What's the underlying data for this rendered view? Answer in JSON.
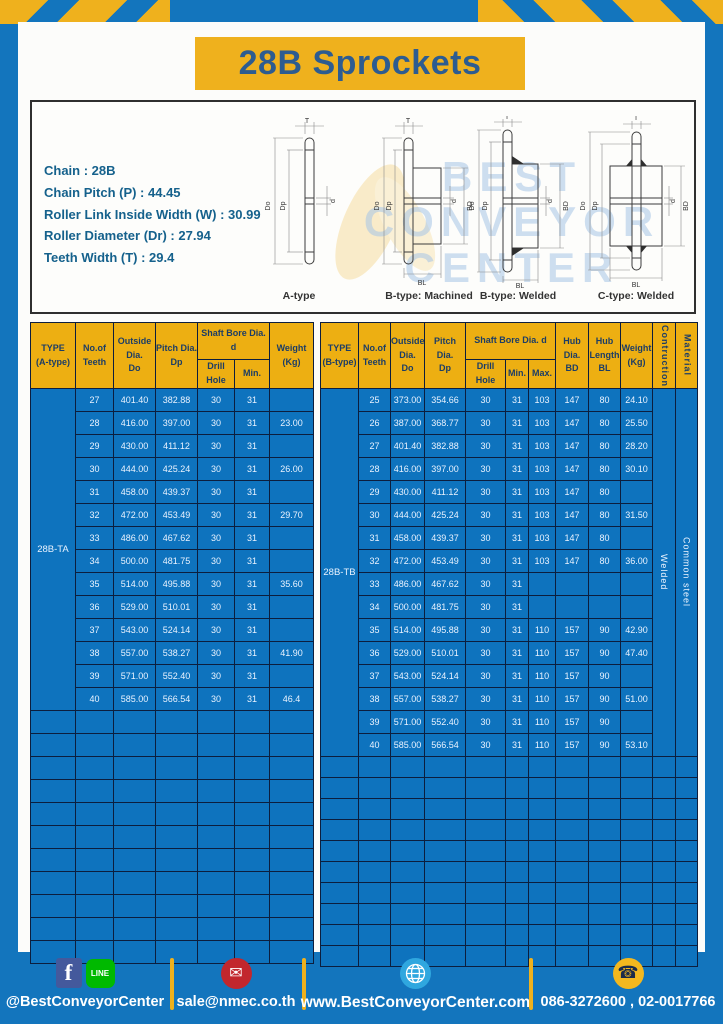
{
  "page": {
    "title": "28B Sprockets"
  },
  "colors": {
    "page_blue": "#1375BD",
    "accent_yellow": "#EFB11D",
    "cell_blue": "#0E73BE",
    "header_navy": "#1C3D66",
    "border_navy": "#0C1E3E",
    "title_navy": "#2D5C90"
  },
  "specs": {
    "lines": [
      "Chain : 28B",
      "Chain Pitch (P) : 44.45",
      "Roller Link Inside Width (W) : 30.99",
      "Roller Diameter (Dr) : 27.94",
      "Teeth Width (T) : 29.4"
    ]
  },
  "watermark": {
    "lines": [
      "BEST",
      "CONVEYOR",
      "CENTER"
    ]
  },
  "diagrams": {
    "captions": [
      "A-type",
      "B-type: Machined",
      "B-type: Welded",
      "C-type: Welded"
    ],
    "dims": {
      "t": "T",
      "do": "Do",
      "dp": "Dp",
      "d": "d",
      "bd": "BD",
      "bl": "BL"
    }
  },
  "table_a": {
    "headers": {
      "type": "TYPE\n(A-type)",
      "teeth": "No.of\nTeeth",
      "outside": "Outside\nDia.\nDo",
      "pitch": "Pitch Dia.\nDp",
      "shaft": "Shaft Bore Dia. d",
      "drill": "Drill Hole",
      "min": "Min.",
      "weight": "Weight\n(Kg)"
    },
    "type_label": "28B-TA",
    "rows": [
      [
        "27",
        "401.40",
        "382.88",
        "30",
        "31",
        ""
      ],
      [
        "28",
        "416.00",
        "397.00",
        "30",
        "31",
        "23.00"
      ],
      [
        "29",
        "430.00",
        "411.12",
        "30",
        "31",
        ""
      ],
      [
        "30",
        "444.00",
        "425.24",
        "30",
        "31",
        "26.00"
      ],
      [
        "31",
        "458.00",
        "439.37",
        "30",
        "31",
        ""
      ],
      [
        "32",
        "472.00",
        "453.49",
        "30",
        "31",
        "29.70"
      ],
      [
        "33",
        "486.00",
        "467.62",
        "30",
        "31",
        ""
      ],
      [
        "34",
        "500.00",
        "481.75",
        "30",
        "31",
        ""
      ],
      [
        "35",
        "514.00",
        "495.88",
        "30",
        "31",
        "35.60"
      ],
      [
        "36",
        "529.00",
        "510.01",
        "30",
        "31",
        ""
      ],
      [
        "37",
        "543.00",
        "524.14",
        "30",
        "31",
        ""
      ],
      [
        "38",
        "557.00",
        "538.27",
        "30",
        "31",
        "41.90"
      ],
      [
        "39",
        "571.00",
        "552.40",
        "30",
        "31",
        ""
      ],
      [
        "40",
        "585.00",
        "566.54",
        "30",
        "31",
        "46.4"
      ]
    ],
    "empty_rows": 11,
    "total_cols": 7
  },
  "table_b": {
    "headers": {
      "type": "TYPE\n(B-type)",
      "teeth": "No.of\nTeeth",
      "outside": "Outside\nDia.\nDo",
      "pitch": "Pitch Dia.\nDp",
      "shaft": "Shaft Bore Dia. d",
      "drill": "Drill Hole",
      "min": "Min.",
      "max": "Max.",
      "hub_dia": "Hub Dia.\nBD",
      "hub_len": "Hub\nLength\nBL",
      "weight": "Weight\n(Kg)",
      "construction": "Contruction",
      "material": "Material"
    },
    "type_label": "28B-TB",
    "construction_value": "Welded",
    "material_value": "Common steel",
    "rows": [
      [
        "25",
        "373.00",
        "354.66",
        "30",
        "31",
        "103",
        "147",
        "80",
        "24.10"
      ],
      [
        "26",
        "387.00",
        "368.77",
        "30",
        "31",
        "103",
        "147",
        "80",
        "25.50"
      ],
      [
        "27",
        "401.40",
        "382.88",
        "30",
        "31",
        "103",
        "147",
        "80",
        "28.20"
      ],
      [
        "28",
        "416.00",
        "397.00",
        "30",
        "31",
        "103",
        "147",
        "80",
        "30.10"
      ],
      [
        "29",
        "430.00",
        "411.12",
        "30",
        "31",
        "103",
        "147",
        "80",
        ""
      ],
      [
        "30",
        "444.00",
        "425.24",
        "30",
        "31",
        "103",
        "147",
        "80",
        "31.50"
      ],
      [
        "31",
        "458.00",
        "439.37",
        "30",
        "31",
        "103",
        "147",
        "80",
        ""
      ],
      [
        "32",
        "472.00",
        "453.49",
        "30",
        "31",
        "103",
        "147",
        "80",
        "36.00"
      ],
      [
        "33",
        "486.00",
        "467.62",
        "30",
        "31",
        "",
        "",
        "",
        ""
      ],
      [
        "34",
        "500.00",
        "481.75",
        "30",
        "31",
        "",
        "",
        "",
        ""
      ],
      [
        "35",
        "514.00",
        "495.88",
        "30",
        "31",
        "110",
        "157",
        "90",
        "42.90"
      ],
      [
        "36",
        "529.00",
        "510.01",
        "30",
        "31",
        "110",
        "157",
        "90",
        "47.40"
      ],
      [
        "37",
        "543.00",
        "524.14",
        "30",
        "31",
        "110",
        "157",
        "90",
        ""
      ],
      [
        "38",
        "557.00",
        "538.27",
        "30",
        "31",
        "110",
        "157",
        "90",
        "51.00"
      ],
      [
        "39",
        "571.00",
        "552.40",
        "30",
        "31",
        "110",
        "157",
        "90",
        ""
      ],
      [
        "40",
        "585.00",
        "566.54",
        "30",
        "31",
        "110",
        "157",
        "90",
        "53.10"
      ]
    ],
    "empty_rows": 10,
    "total_cols": 12
  },
  "footer": {
    "social": {
      "label": "@BestConveyorCenter",
      "fb_glyph": "f",
      "line_text": "LINE"
    },
    "email": {
      "label": "sale@nmec.co.th",
      "glyph": "✉"
    },
    "website": {
      "label": "www.BestConveyorCenter.com"
    },
    "phone": {
      "label": "086-3272600 , 02-0017766",
      "glyph": "☎"
    }
  }
}
